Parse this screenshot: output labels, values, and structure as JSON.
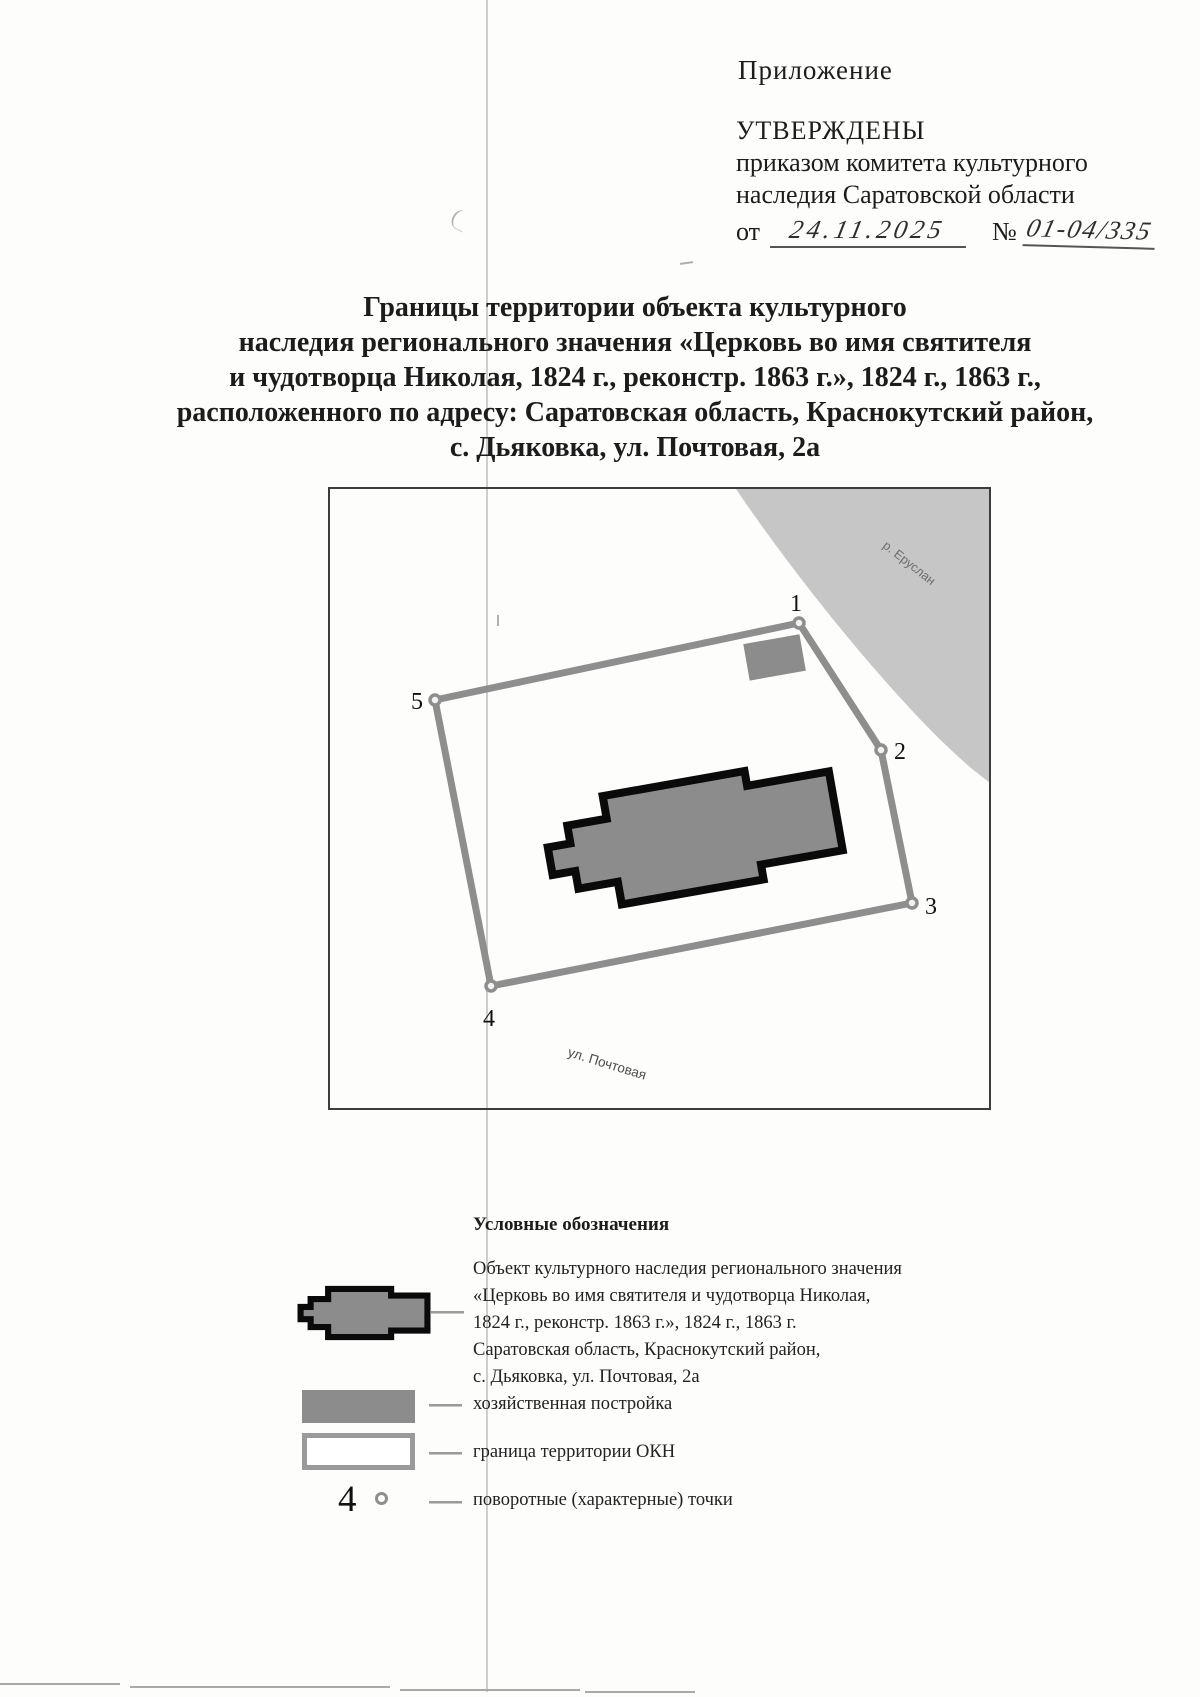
{
  "document": {
    "appendix_label": "Приложение",
    "approval": {
      "approved_word": "УТВЕРЖДЕНЫ",
      "by_line1": "приказом комитета культурного",
      "by_line2": "наследия Саратовской области",
      "date_prefix": "от",
      "date_handwritten": "24.11.2025",
      "number_prefix": "№",
      "number_handwritten": "01-04/335"
    },
    "title_lines": [
      "Границы территории объекта культурного",
      "наследия регионального значения «Церковь во имя святителя",
      "и чудотворца Николая, 1824 г., реконстр. 1863 г.», 1824 г., 1863 г.,",
      "расположенного по адресу: Саратовская область, Краснокутский район,",
      "с. Дьяковка, ул. Почтовая, 2а"
    ]
  },
  "map": {
    "river_label": "р. Еруслан",
    "street_label": "ул. Почтовая",
    "point_labels": [
      "1",
      "2",
      "3",
      "4",
      "5"
    ]
  },
  "legend": {
    "heading": "Условные обозначения",
    "item1_lines": [
      "Объект культурного наследия регионального значения",
      "«Церковь во имя святителя и чудотворца Николая,",
      "1824 г., реконстр. 1863 г.», 1824 г., 1863 г.",
      "Саратовская область, Краснокутский район,",
      "с. Дьяковка, ул. Почтовая, 2а"
    ],
    "item2_label": "хозяйственная постройка",
    "item3_label": "граница территории ОКН",
    "item4_label": "поворотные (характерные) точки",
    "item4_number": "4"
  },
  "colors": {
    "building_fill": "#8c8c8c",
    "building_outline": "#0a0a0a",
    "river_fill": "#c6c6c6",
    "boundary_line": "#8e8e8e",
    "map_frame": "#3d3d3d"
  }
}
